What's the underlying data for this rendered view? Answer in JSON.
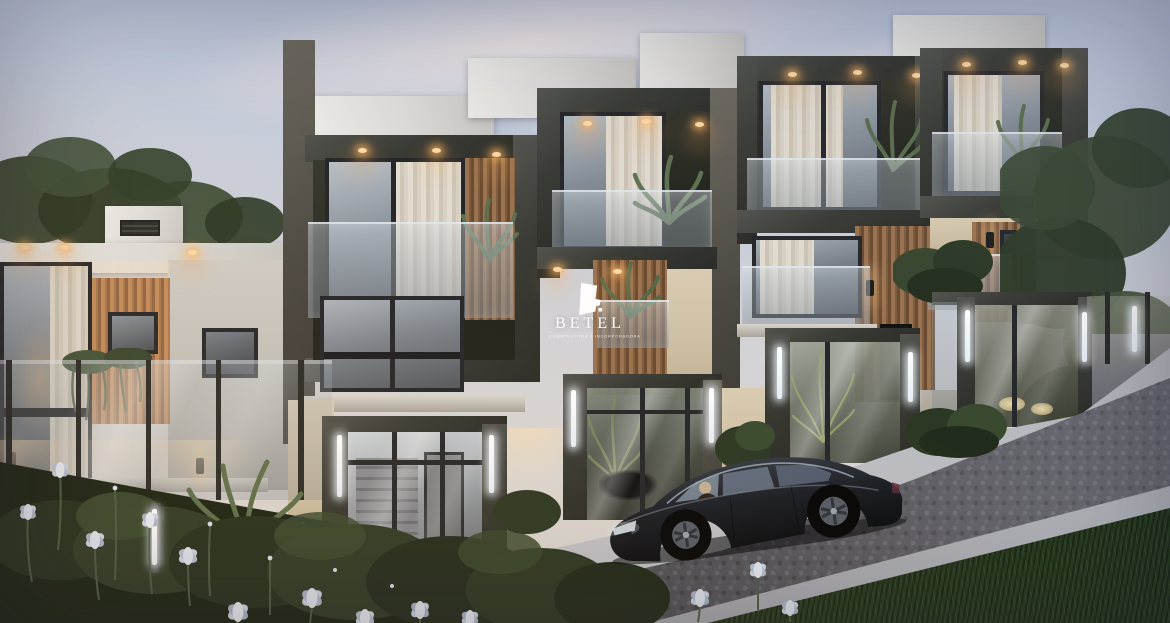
{
  "watermark": {
    "brand": "BETEL",
    "tagline": "CONSTRUTORA E INCORPORADORA",
    "logo_icon": "betel-logo-icon"
  },
  "palette": {
    "sky_top": "#bec8dd",
    "sky_horizon": "#dad6d3",
    "cloud_shadow": "#8494b4",
    "concrete_frame_dark": "#3a3b35",
    "parapet_white": "#e2e0dc",
    "stucco_beige": "#d2c5ab",
    "wood_slat": "#b08254",
    "window_glass": "#9aa5ae",
    "curtain": "#dcd4c5",
    "warm_downlight": "#ffc77e",
    "led_strip_white": "#eef4f8",
    "cobblestone": "#4d4d52",
    "sidewalk_concrete": "#b9bbc0",
    "foliage_dark": "#32402c",
    "grass": "#2b3d24",
    "iris_flower": "#c9d3e2",
    "car_black": "#14171c"
  }
}
